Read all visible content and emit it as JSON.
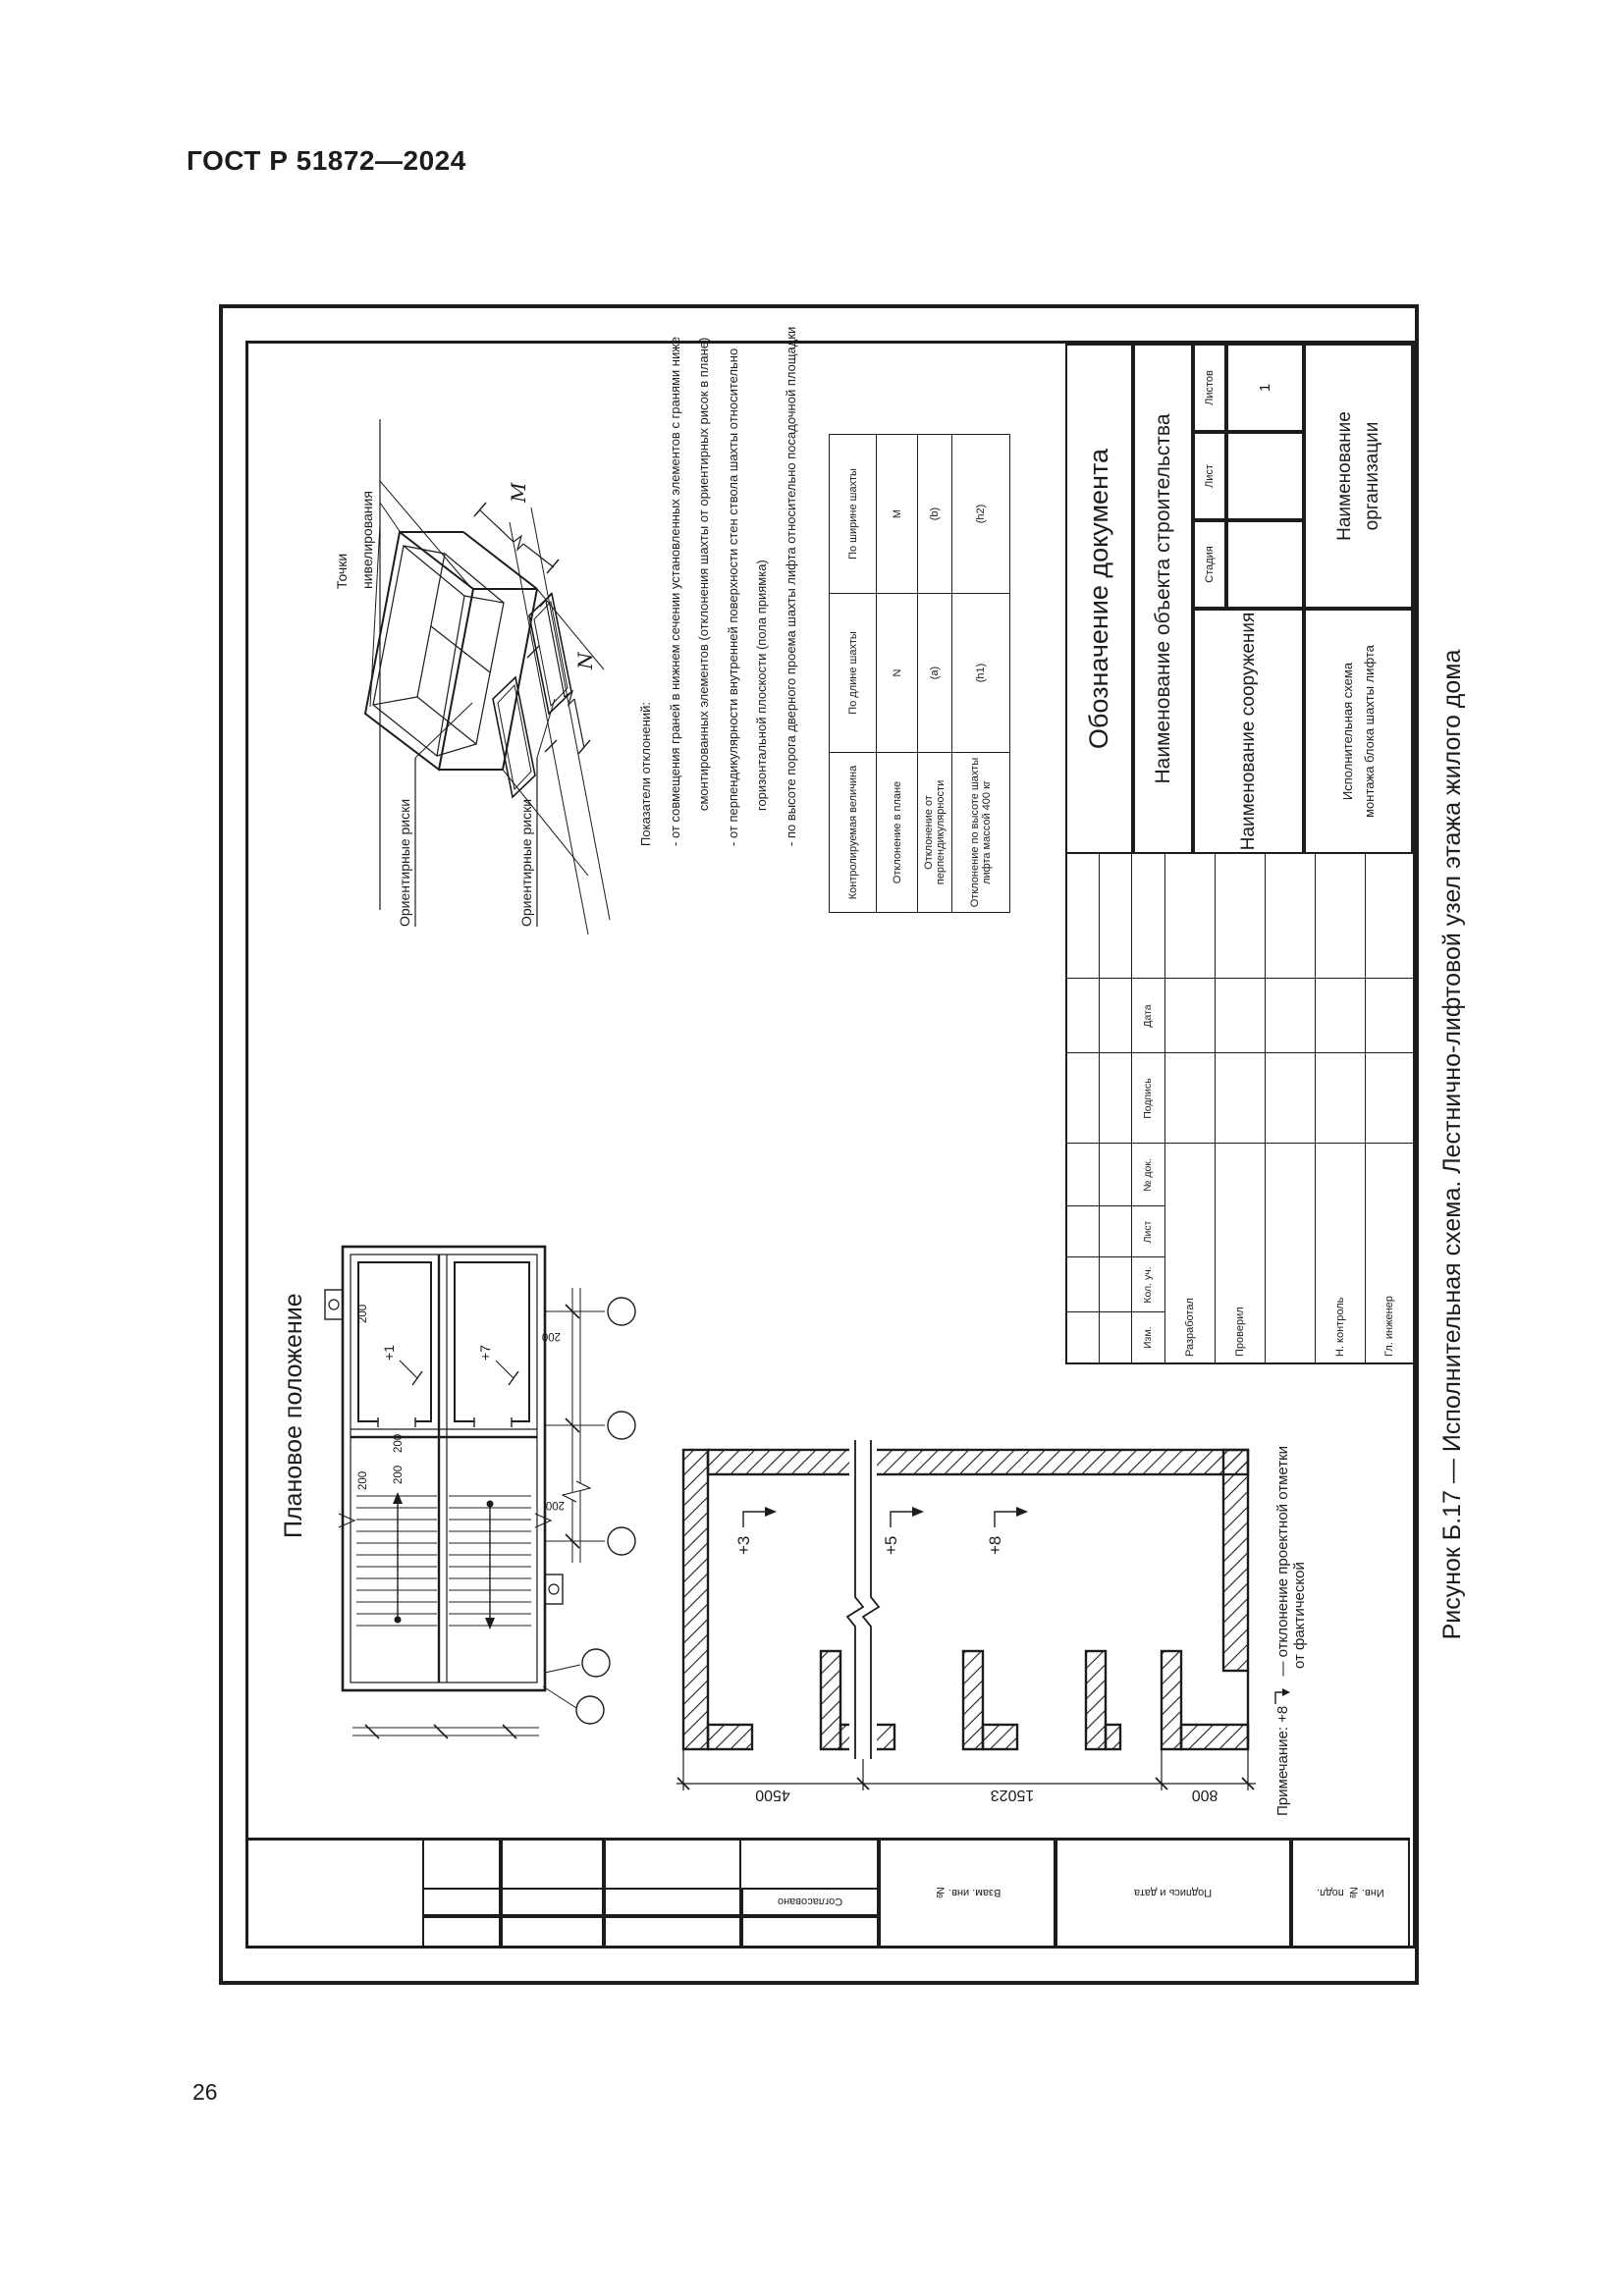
{
  "page": {
    "standard": "ГОСТ Р 51872—2024",
    "number": "26"
  },
  "figure": {
    "caption": "Рисунок Б.17 — Исполнительная схема. Лестнично-лифтовой узел этажа жилого дома"
  },
  "axon": {
    "leveling_line1": "Точки",
    "leveling_line2": "нивелирования",
    "marks_label_1": "Ориентирные риски",
    "marks_label_2": "Ориентирные риски",
    "dim_width": "M",
    "dim_length": "N"
  },
  "deviations": {
    "title": "Показатели отклонений:",
    "line1": "- от совмещения граней в нижнем сечении установленных элементов с гранями ниже",
    "line2": "смонтированных элементов (отклонения шахты от ориентирных рисок в плане)",
    "line3": "- от перпендикулярности внутренней поверхности стен ствола шахты относительно",
    "line4": "горизонтальной плоскости (пола приямка)",
    "line5": "- по высоте порога дверного проема шахты лифта относительно посадочной площадки"
  },
  "spec_table": {
    "col_param": "Контролируемая величина",
    "col_length": "По длине шахты",
    "col_width": "По ширине шахты",
    "rows": [
      {
        "p": "Отклонение в плане",
        "l": "N",
        "w": "M"
      },
      {
        "p": "Отклонение от перпендикулярности",
        "l": "(a)",
        "w": "(b)"
      },
      {
        "p1": "Отклонение по высоте шахты",
        "p2": "лифта массой 400 кг",
        "l": "(h1)",
        "w": "(h2)"
      }
    ]
  },
  "plan": {
    "title": "Плановое положение",
    "shaft1_dev": "+1",
    "shaft2_dev": "+7",
    "offset": "200"
  },
  "section": {
    "dim_top": "4500",
    "dim_mid": "15023",
    "dim_bottom": "800",
    "mark1": "+3",
    "mark2": "+5",
    "mark3": "+8",
    "note_label": "Примечание: +8",
    "note_line1": "— отклонение проектной отметки",
    "note_line2": "от фактической"
  },
  "title_block": {
    "doc": "Обозначение документа",
    "object": "Наименование объекта строительства",
    "facility": "Наименование сооружения",
    "scheme_line1": "Исполнительная  схема",
    "scheme_line2": "монтажа  блока  шахты  лифта",
    "org_line1": "Наименование",
    "org_line2": "организации",
    "stage": "Стадия",
    "sheet": "Лист",
    "sheets": "Листов",
    "sheets_value": "1",
    "cols": [
      "Изм.",
      "Кол. уч.",
      "Лист",
      "№ док.",
      "Подпись",
      "Дата"
    ],
    "staff": [
      "Разработал",
      "Проверил",
      "",
      "Н. контроль",
      "Гл. инженер"
    ]
  },
  "margin": {
    "approved": "Согласовано",
    "replace_inv": "Взам. инв. №",
    "sign_date": "Подпись и дата",
    "inventory": "Инв. № подл."
  }
}
